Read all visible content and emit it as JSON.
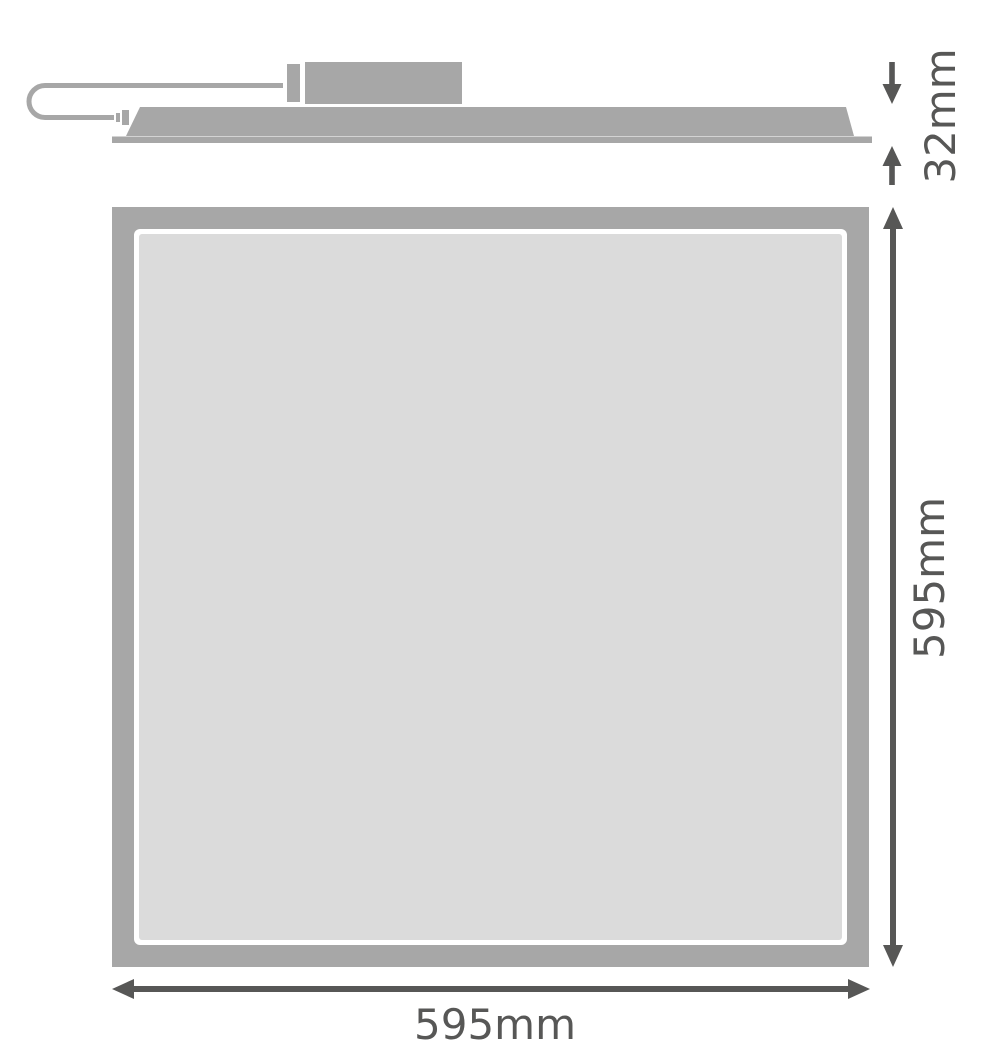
{
  "diagram": {
    "title": "LED panel luminaire dimension drawing",
    "views": [
      "side-profile",
      "front-face"
    ]
  },
  "dimensions": {
    "profile_height": "32mm",
    "panel_height": "595mm",
    "panel_width": "595mm"
  },
  "colors": {
    "background": "#ffffff",
    "shape_gray": "#a7a7a7",
    "panel_face_gray": "#dbdbdb",
    "dimension_dark": "#575756"
  }
}
